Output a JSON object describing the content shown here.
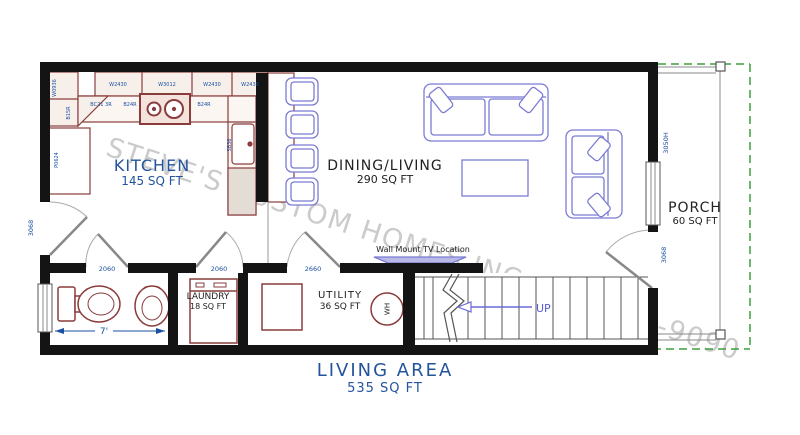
{
  "plan": {
    "watermark": "STEVE'S CUSTOM HOMES,INC. 207-713-9090",
    "title": {
      "label": "LIVING AREA",
      "area": "535 SQ FT"
    },
    "rooms": {
      "kitchen": {
        "name": "KITCHEN",
        "area": "145 SQ FT"
      },
      "dining": {
        "name": "DINING/LIVING",
        "area": "290 SQ FT"
      },
      "porch": {
        "name": "PORCH",
        "area": "60 SQ FT"
      },
      "laundry": {
        "name": "LAUNDRY",
        "area": "18 SQ FT"
      },
      "utility": {
        "name": "UTILITY",
        "area": "36 SQ FT"
      }
    },
    "annotations": {
      "tv": "Wall Mount TV Location",
      "up": "UP",
      "water_heater": "WH",
      "bath_width": "7'"
    },
    "door_labels": {
      "entry": "3068",
      "bath": "2060",
      "laundry": "2060",
      "utility": "2660",
      "porch": "3068"
    },
    "window_labels": {
      "living": "3050H"
    },
    "cabinet_labels": {
      "wall1": "W2430",
      "wall2": "W3012",
      "wall3": "W2430",
      "wall4": "W2430",
      "base1": "BC21 3R",
      "base2": "B24R",
      "base3": "B24R",
      "left1": "W0936",
      "left2": "B15R",
      "tall": "P0624",
      "sink": "SB36"
    },
    "colors": {
      "wall": "#141414",
      "cabinet": "#8a3c3c",
      "furniture": "#7b7bd4",
      "label_blue": "#1a50a2",
      "title_blue": "#24549c",
      "porch_green": "#3da03d",
      "watermark": "#cbcbcb"
    }
  }
}
